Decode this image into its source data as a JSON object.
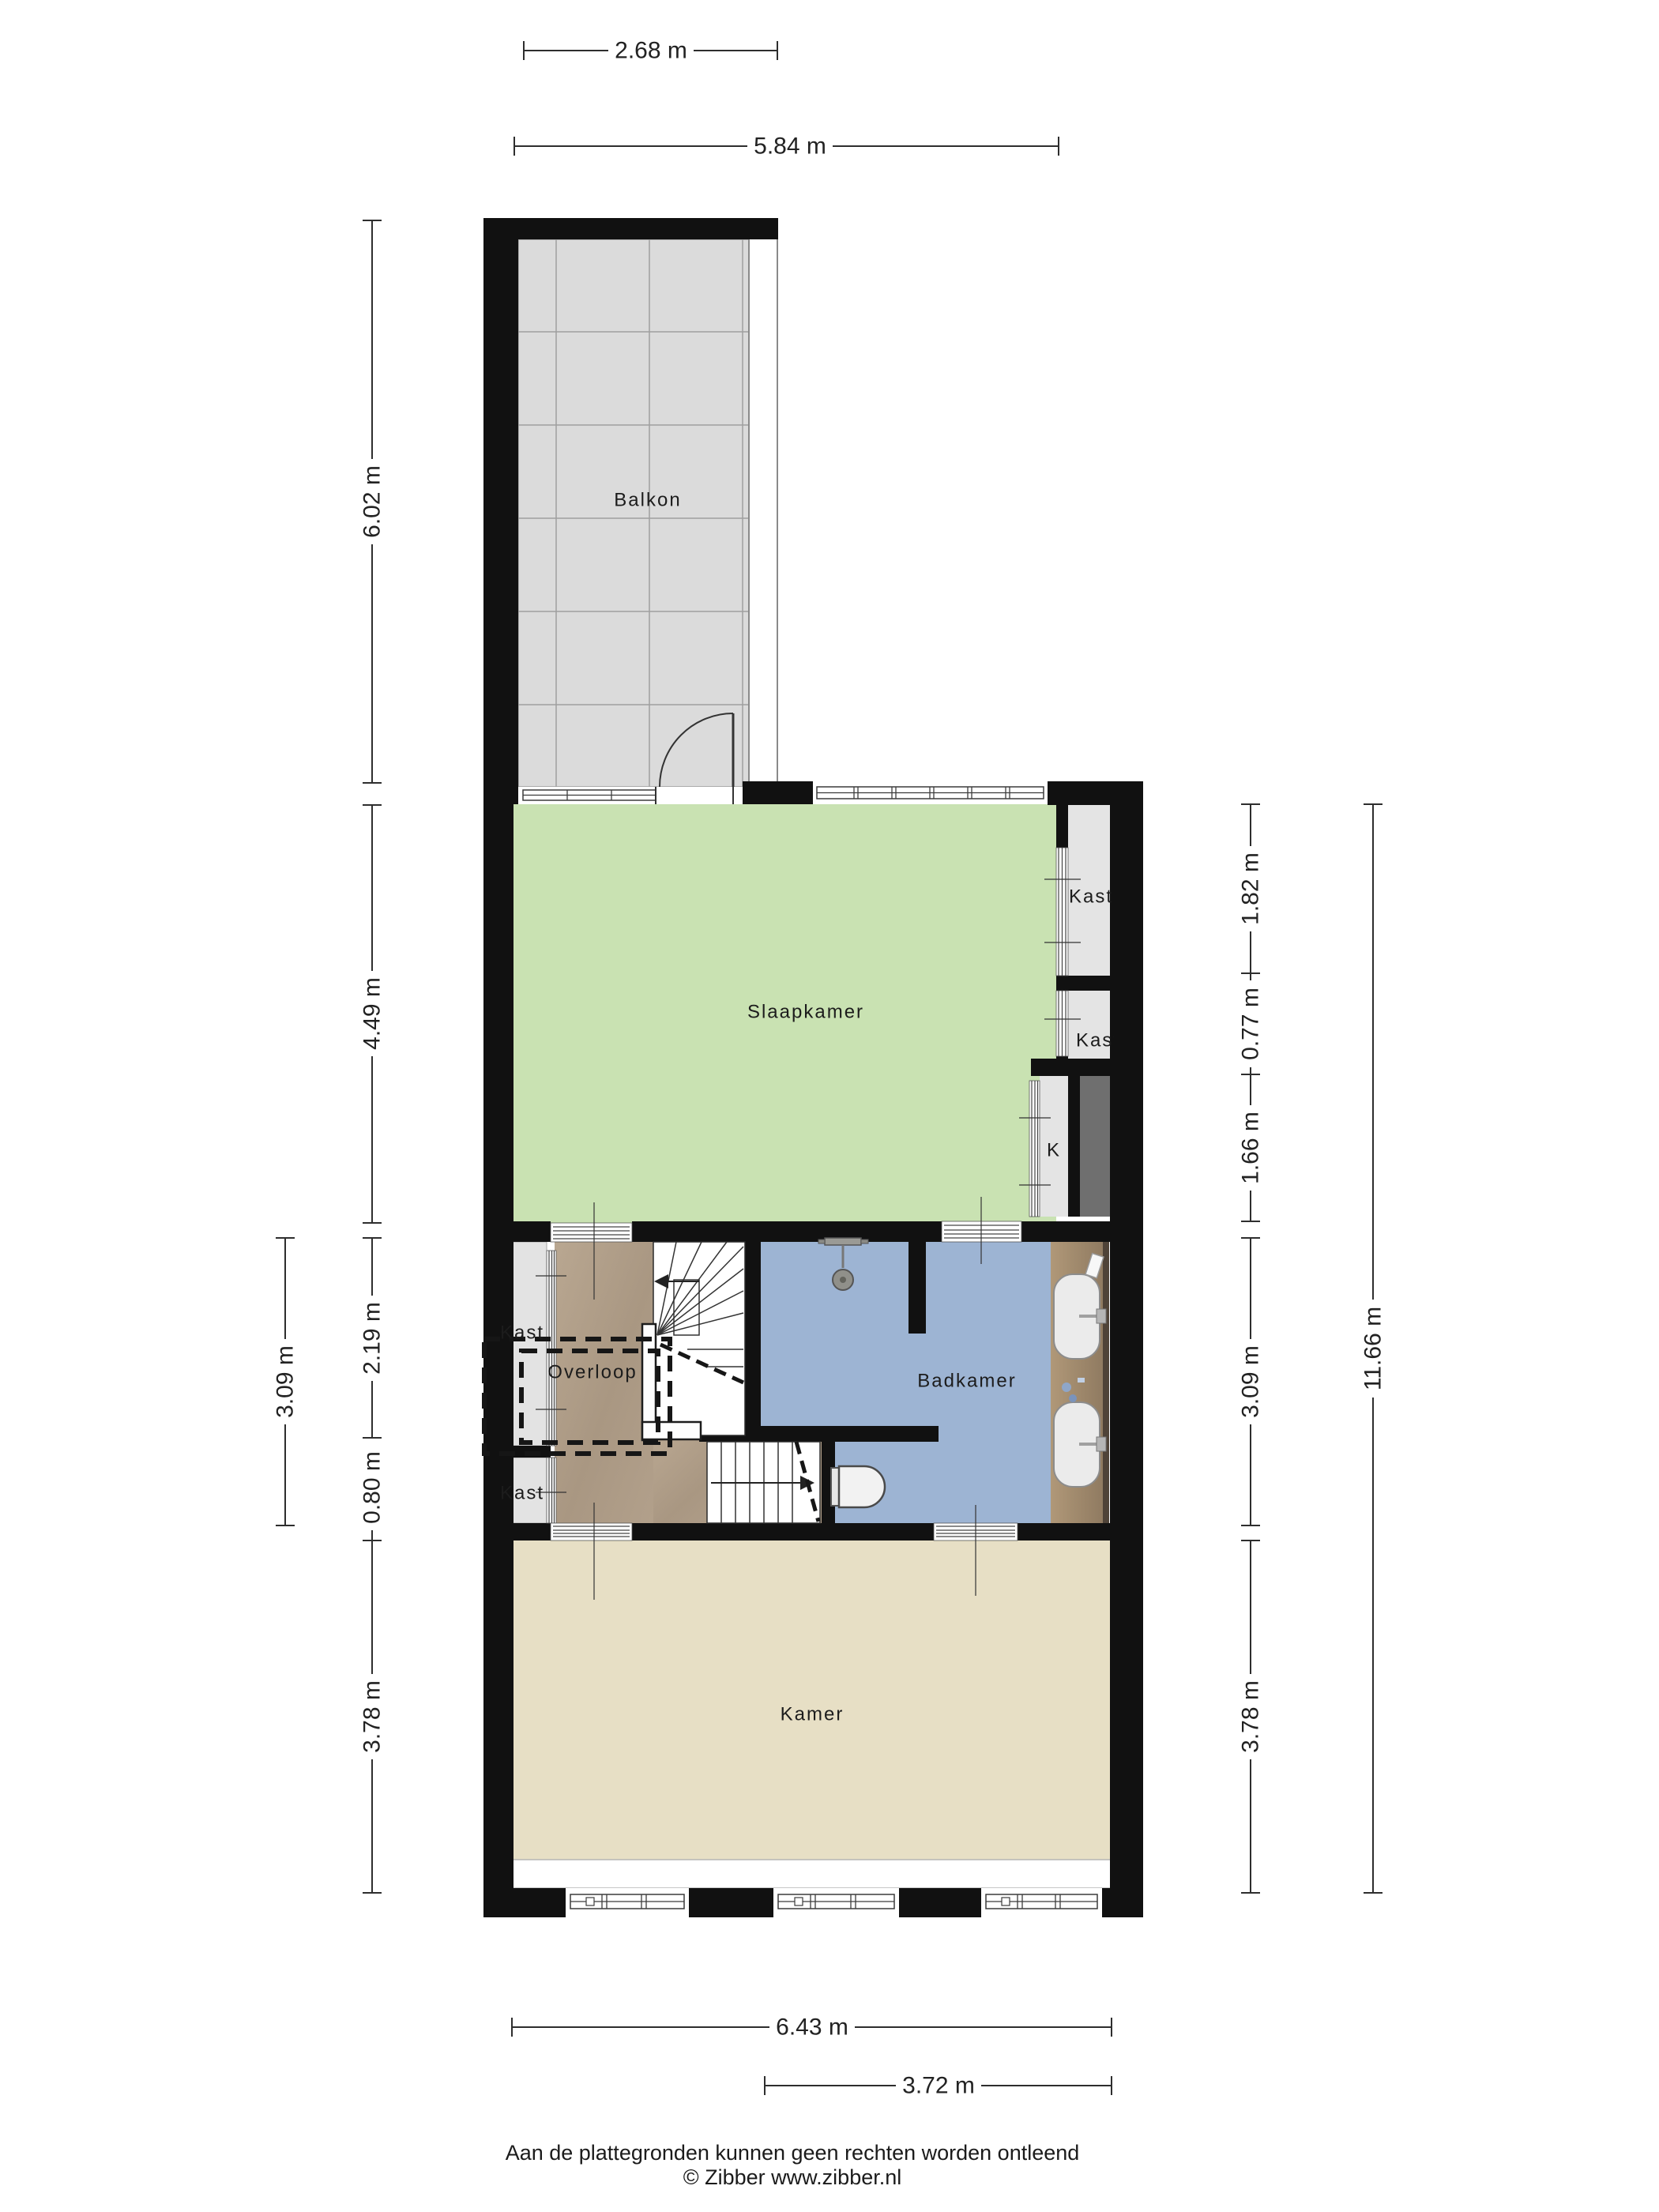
{
  "plan": {
    "labels": {
      "balkon": "Balkon",
      "slaapkamer": "Slaapkamer",
      "overloop": "Overloop",
      "badkamer": "Badkamer",
      "kamer": "Kamer",
      "kast_right_top": "Kast",
      "kast_right_mid": "Kast",
      "k_closet": "K",
      "kast_left_top": "Kast",
      "kast_left_bottom": "Kast"
    },
    "dimensions": {
      "top_width_balcony": "2.68 m",
      "top_width_bedroom": "5.84 m",
      "left_balcony_depth": "6.02 m",
      "left_bedroom_depth": "4.49 m",
      "left_landing_depth": "2.19 m",
      "left_closet_depth": "0.80 m",
      "left_room_depth": "3.78 m",
      "left_middle_total": "3.09 m",
      "right_closet_top": "1.82 m",
      "right_closet_mid": "0.77 m",
      "right_closet_bottom": "1.66 m",
      "right_bathroom_depth": "3.09 m",
      "right_room_depth": "3.78 m",
      "right_total_depth": "11.66 m",
      "bottom_width_total": "6.43 m",
      "bottom_width_partial": "3.72 m"
    },
    "colors": {
      "wall": "#111111",
      "bedroom_green": "#c9e2b2",
      "room_beige": "#e7dfc5",
      "bathroom_blue": "#9db4d3",
      "landing_brown": "#b2a08b",
      "balcony_tile": "#dbdbdb",
      "closet_gray": "#e4e4e4",
      "shaft_gray": "#6f6f6f",
      "counter_wood": "#a89073",
      "dimension_text": "#222222"
    }
  },
  "footer": {
    "disclaimer": "Aan de plattegronden kunnen geen rechten worden ontleend",
    "copyright": "© Zibber www.zibber.nl"
  }
}
